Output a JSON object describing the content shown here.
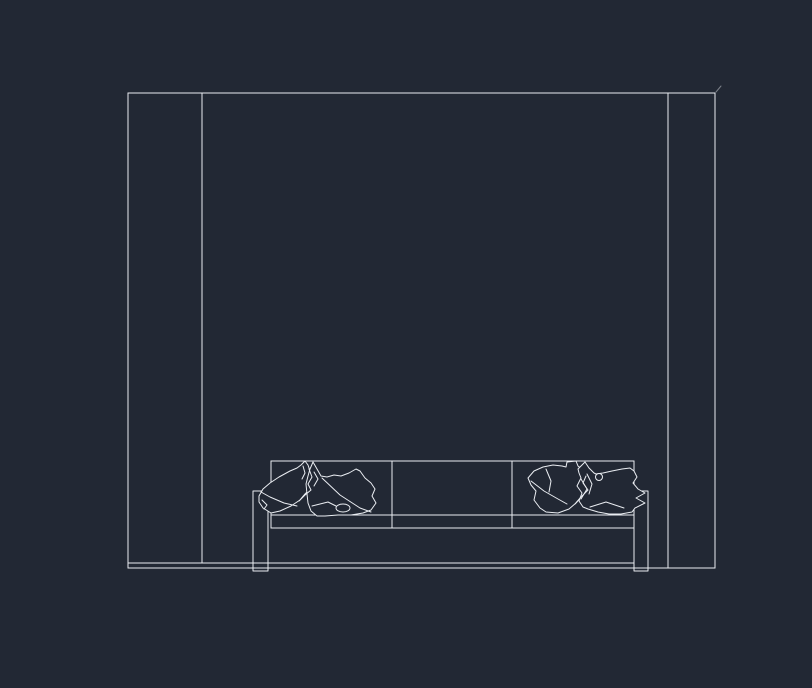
{
  "canvas": {
    "width": 812,
    "height": 688,
    "background": "#222834",
    "line_color": "#eaedf2"
  },
  "drawing": {
    "entities": [
      {
        "name": "wall-top-edge",
        "type": "line",
        "x1": 128,
        "y1": 93,
        "x2": 715,
        "y2": 93
      },
      {
        "name": "wall-left-outer-edge",
        "type": "line",
        "x1": 128,
        "y1": 93,
        "x2": 128,
        "y2": 568
      },
      {
        "name": "wall-left-inner-edge",
        "type": "line",
        "x1": 202,
        "y1": 93,
        "x2": 202,
        "y2": 563
      },
      {
        "name": "wall-right-inner-edge",
        "type": "line",
        "x1": 668,
        "y1": 93,
        "x2": 668,
        "y2": 568
      },
      {
        "name": "wall-right-outer-edge",
        "type": "line",
        "x1": 715,
        "y1": 93,
        "x2": 715,
        "y2": 568
      },
      {
        "name": "floor-line",
        "type": "line",
        "x1": 128,
        "y1": 568,
        "x2": 715,
        "y2": 568
      },
      {
        "name": "sofa-base-line",
        "type": "line",
        "x1": 128,
        "y1": 563,
        "x2": 634,
        "y2": 563
      },
      {
        "name": "corner-speck",
        "type": "line",
        "x1": 716,
        "y1": 92,
        "x2": 721,
        "y2": 86,
        "opacity": 0.45
      },
      {
        "name": "sofa-back-top-edge",
        "type": "line",
        "x1": 271,
        "y1": 461,
        "x2": 634,
        "y2": 461
      },
      {
        "name": "sofa-back-left-edge",
        "type": "line",
        "x1": 271,
        "y1": 461,
        "x2": 271,
        "y2": 528
      },
      {
        "name": "sofa-back-right-edge",
        "type": "line",
        "x1": 634,
        "y1": 461,
        "x2": 634,
        "y2": 491
      },
      {
        "name": "sofa-seat-line",
        "type": "line",
        "x1": 271,
        "y1": 515,
        "x2": 634,
        "y2": 515
      },
      {
        "name": "sofa-seat-bottom-line",
        "type": "line",
        "x1": 271,
        "y1": 528,
        "x2": 634,
        "y2": 528
      },
      {
        "name": "sofa-back-divider-left",
        "type": "line",
        "x1": 392,
        "y1": 461,
        "x2": 392,
        "y2": 528
      },
      {
        "name": "sofa-back-divider-right",
        "type": "line",
        "x1": 512,
        "y1": 461,
        "x2": 512,
        "y2": 528
      },
      {
        "name": "sofa-armrest-left",
        "type": "rect",
        "x": 253,
        "y": 491,
        "w": 15,
        "h": 80
      },
      {
        "name": "sofa-armrest-right",
        "type": "rect",
        "x": 634,
        "y": 491,
        "w": 14,
        "h": 80
      },
      {
        "name": "pillow-left-back-outline",
        "type": "path",
        "fill": "bg",
        "d": "M259,496 L263,489 L270,483 L279,477 L290,471 L297,468 L301,465 L305,461 L308,465 L310,471 L311,477 L307,483 L310,489 L305,494 L300,500 L291,506 L280,511 L271,513 L263,508 L259,502 Z"
      },
      {
        "name": "pillow-left-back-fold",
        "type": "polyline",
        "points": "261,492 270,497 284,503 297,506"
      },
      {
        "name": "pillow-left-back-fold",
        "type": "polyline",
        "points": "303,466 305,473 302,479"
      },
      {
        "name": "pillow-left-back-fold",
        "type": "polyline",
        "points": "262,500 267,505 264,509"
      },
      {
        "name": "pillow-left-front-outline",
        "type": "path",
        "fill": "bg",
        "d": "M313,462 L317,469 L321,476 L327,477 L334,475 L341,476 L349,473 L356,469 L360,471 L365,478 L371,483 L375,489 L372,496 L376,503 L371,510 L363,513 L351,515 L338,515 L325,516 L317,516 L311,511 L308,503 L307,494 L306,484 L308,476 L310,469 Z"
      },
      {
        "name": "pillow-left-front-fold",
        "type": "polyline",
        "points": "314,472 318,479 314,486"
      },
      {
        "name": "pillow-left-front-fold",
        "type": "polyline",
        "points": "322,478 340,495 360,508 371,512"
      },
      {
        "name": "pillow-left-front-fold",
        "type": "polyline",
        "points": "312,506 328,502 336,506"
      },
      {
        "name": "pillow-left-front-tuft",
        "type": "ellipse",
        "cx": 343,
        "cy": 508,
        "rx": 7,
        "ry": 4,
        "fill": "bg"
      },
      {
        "name": "pillow-left-overlap-fold",
        "type": "polyline",
        "points": "309,469 312,477 308,484 311,490 305,495 299,501"
      },
      {
        "name": "pillow-right-back-outline",
        "type": "path",
        "fill": "bg",
        "d": "M528,478 L534,471 L543,467 L553,465 L562,466 L566,467 L567,462 L576,461 L578,466 L583,470 L587,475 L583,482 L588,489 L582,496 L576,503 L569,509 L558,513 L546,512 L540,508 L534,500 L536,491 L531,485 Z"
      },
      {
        "name": "pillow-right-back-fold",
        "type": "polyline",
        "points": "531,481 544,491 558,499 567,504"
      },
      {
        "name": "pillow-right-back-fold",
        "type": "polyline",
        "points": "546,469 551,481 549,492"
      },
      {
        "name": "pillow-right-front-outline",
        "type": "path",
        "fill": "bg",
        "d": "M578,469 L582,465 L585,462 L589,468 L594,473 L596,474 L603,473 L612,471 L622,469 L630,468 L634,471 L637,477 L633,483 L638,489 L645,493 L636,498 L645,503 L635,508 L632,512 L621,514 L609,514 L598,512 L588,509 L583,507 L579,501 L582,493 L577,486 L581,478 L579,473 Z"
      },
      {
        "name": "pillow-right-front-fold",
        "type": "polyline",
        "points": "581,479 587,489 581,499"
      },
      {
        "name": "pillow-right-front-fold",
        "type": "polyline",
        "points": "587,474 592,484 589,494"
      },
      {
        "name": "pillow-right-front-fold",
        "type": "polyline",
        "points": "590,507 606,502 624,508"
      },
      {
        "name": "pillow-right-front-button",
        "type": "circle",
        "cx": 599,
        "cy": 477,
        "r": 3.5,
        "fill": "bg"
      },
      {
        "name": "pillow-right-overlap-fold",
        "type": "polyline",
        "points": "586,476 583,483 588,490 581,497 575,504"
      }
    ]
  }
}
